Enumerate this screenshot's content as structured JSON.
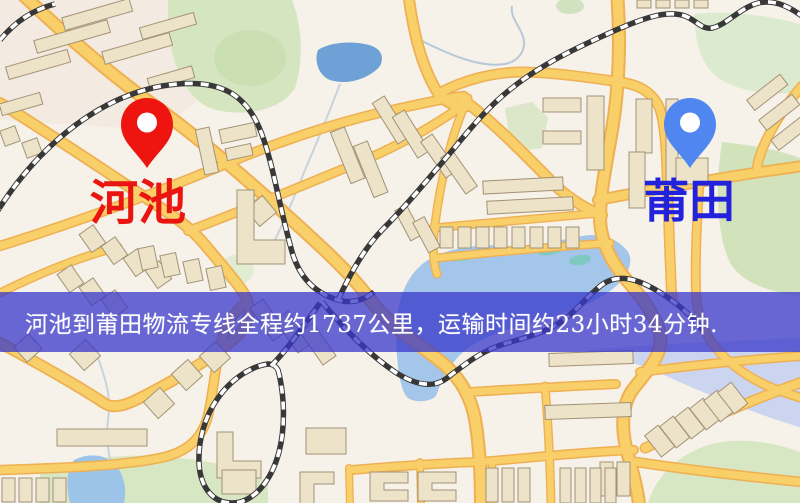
{
  "map": {
    "origin": {
      "name": "河池",
      "label_color": "#ea1410",
      "pin_color": "#ee1510"
    },
    "destination": {
      "name": "莆田",
      "label_color": "#2222dd",
      "pin_color": "#4f86f0"
    },
    "palette": {
      "land": "#f6f1e9",
      "road_fill": "#f8cf68",
      "road_casing": "#eeb052",
      "building_fill": "#ece3c9",
      "building_stroke": "#a39276",
      "park_green": "#d5e5c0",
      "water_blue": "#a3c6ea",
      "lake_deep": "#6ea1d6",
      "railway_dark": "#383838",
      "banner_overlay": "rgba(56,55,202,0.75)"
    }
  },
  "banner": {
    "text": "河池到莆田物流专线全程约1737公里，运输时间约23小时34分钟.",
    "text_color": "#ffffff"
  }
}
